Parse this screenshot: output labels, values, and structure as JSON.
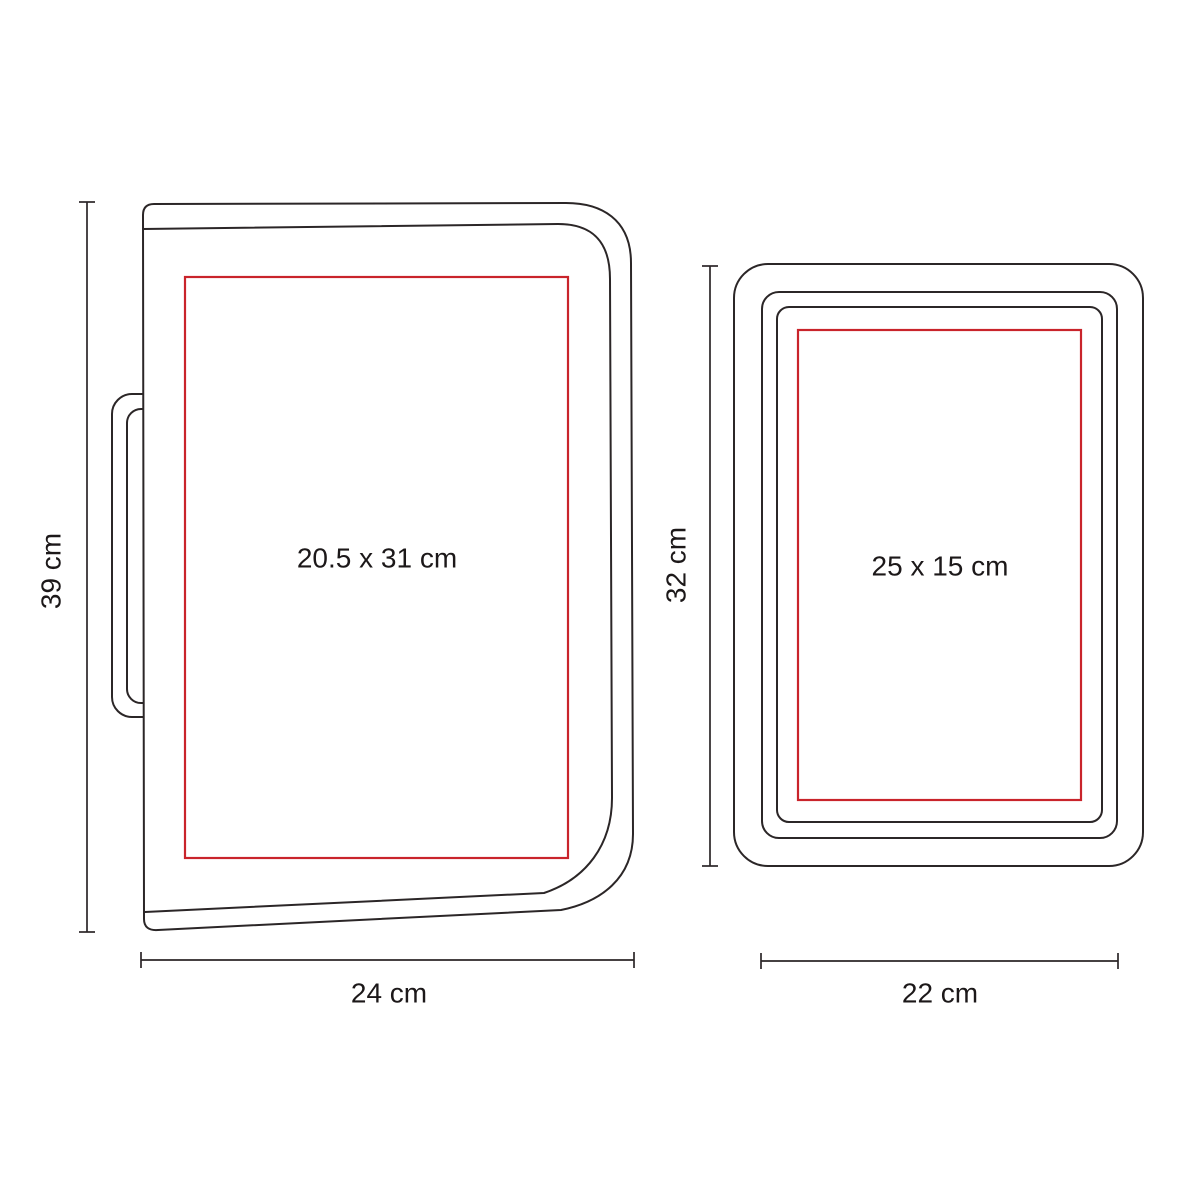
{
  "diagram_title": "product-print-area-dimension-diagram",
  "colors": {
    "line": "#2b2627",
    "accent": "#c9242b",
    "text": "#1c1819",
    "bg": "#ffffff"
  },
  "portfolio": {
    "print_area_label": "20.5 x 31 cm",
    "height_label": "39 cm",
    "width_label": "24 cm"
  },
  "sleeve": {
    "print_area_label": "25 x 15 cm",
    "height_label": "32 cm",
    "width_label": "22 cm"
  }
}
